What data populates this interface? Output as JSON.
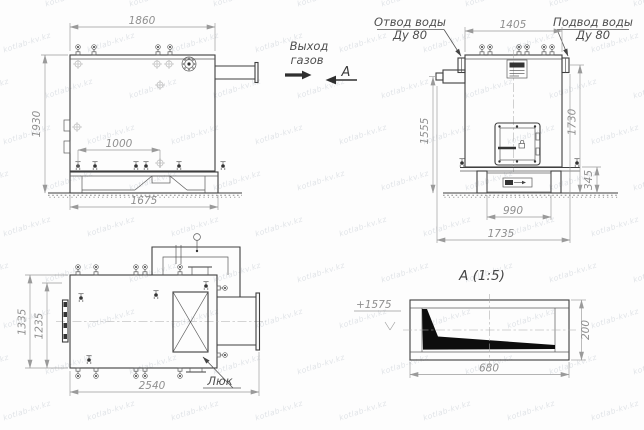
{
  "colors": {
    "line": "#3f3f3f",
    "dim_text": "#8f8f8f",
    "label_text": "#4f4f4f",
    "watermark": "#c9cfd6",
    "section_fill": "#0d0d0d"
  },
  "watermark": {
    "text": "kotlab-kv.kz"
  },
  "side_view": {
    "dim_width_top": "1860",
    "dim_height_left": "1930",
    "dim_valve_spacing": "1000",
    "dim_base_width": "1675",
    "label_gas_outlet_line1": "Выход",
    "label_gas_outlet_line2": "газов",
    "section_arrow_label": "А"
  },
  "front_view": {
    "label_water_outlet_line1": "Отвод воды",
    "label_water_outlet_line2": "Ду 80",
    "label_water_inlet_line1": "Подвод воды",
    "label_water_inlet_line2": "Ду 80",
    "dim_width_top": "1405",
    "dim_height_burner_axis": "1555",
    "dim_height_inlet": "1730",
    "dim_frame_height": "345",
    "dim_frame_width": "990",
    "dim_depth_overall": "1735"
  },
  "plan_view": {
    "dim_width_outer": "1335",
    "dim_width_inner": "1235",
    "dim_length": "2540",
    "label_hatch": "Люк"
  },
  "section_view": {
    "title": "А (1:5)",
    "dim_width": "680",
    "dim_height": "200",
    "elevation_mark": "+1575"
  }
}
